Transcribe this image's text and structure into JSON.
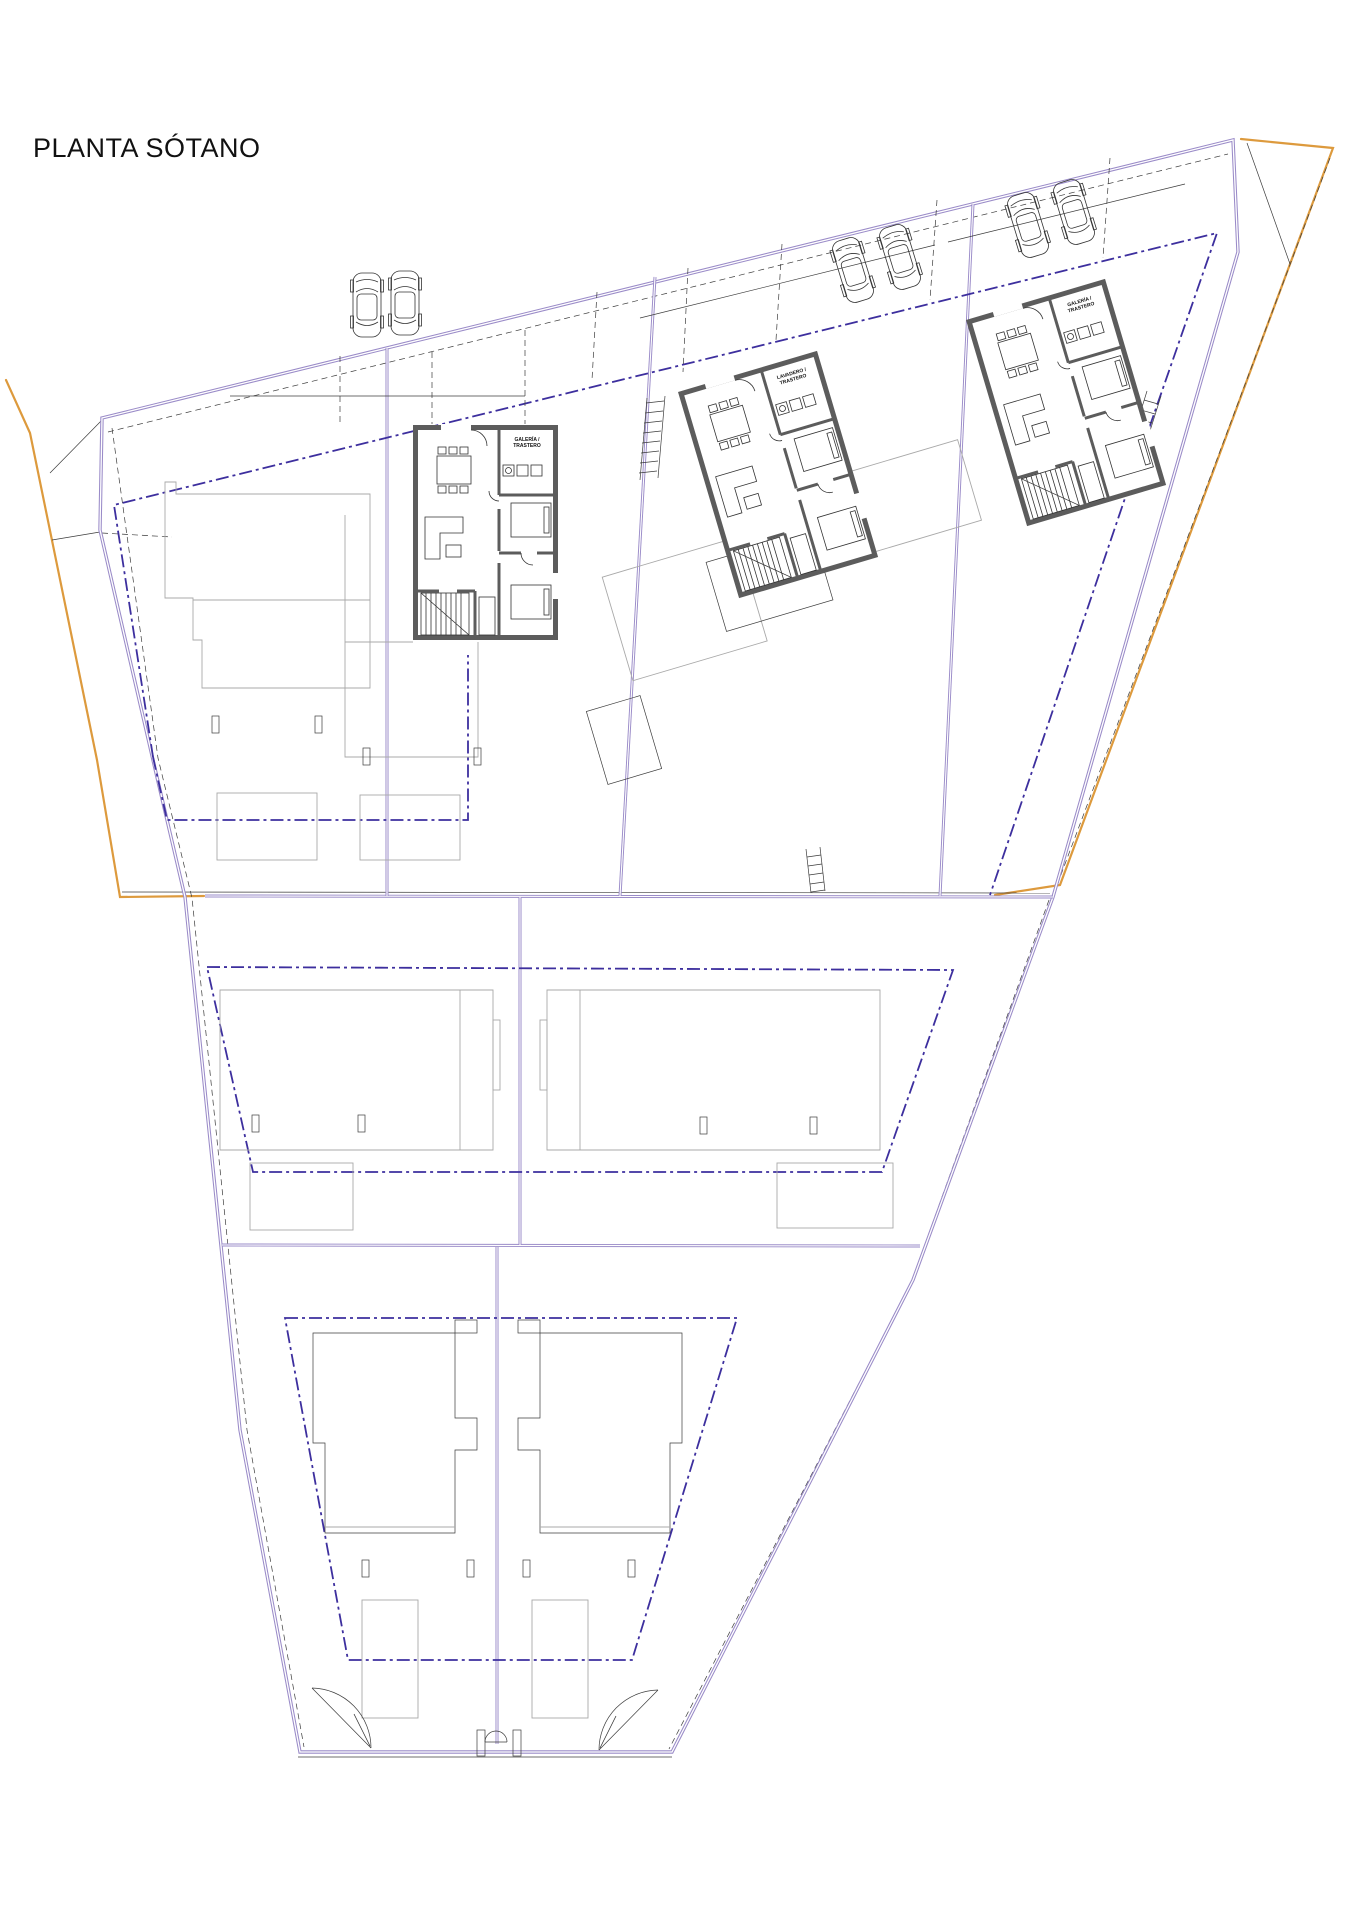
{
  "title": "PLANTA SÓTANO",
  "units": [
    {
      "name": "unit-left",
      "label_line1": "GALERÍA /",
      "label_line2": "TRASTERO"
    },
    {
      "name": "unit-middle",
      "label_line1": "LAVADERO /",
      "label_line2": "TRASTERO"
    },
    {
      "name": "unit-right",
      "label_line1": "GALERÍA /",
      "label_line2": "TRASTERO"
    }
  ],
  "icons": {
    "car": "car-top-view-icon",
    "pool": "pool-rectangle",
    "stairs": "stair-hatch"
  },
  "colors": {
    "boundary": "#9a8bc8",
    "setback": "#3d2f9e",
    "road": "#dd9a3d",
    "wall": "#5c5c5c",
    "outline": "#a9a9a9",
    "linework": "#333333",
    "text": "#111111",
    "background": "#ffffff"
  }
}
